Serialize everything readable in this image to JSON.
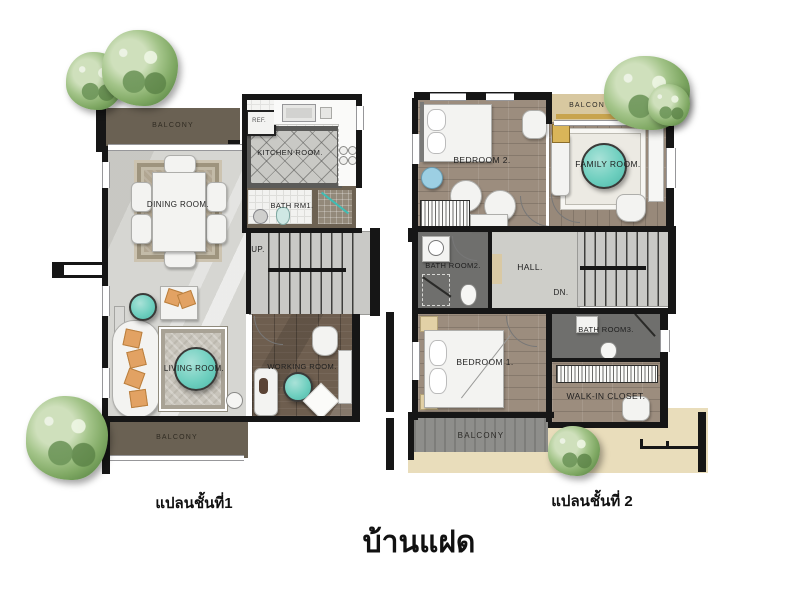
{
  "title": "บ้านแฝด",
  "floor1": {
    "caption": "แปลนชั้นที่1",
    "rooms": {
      "balcony_top": "BALCONY",
      "ref": "REF.",
      "kitchen": "KITCHEN ROOM.",
      "dining": "DINING ROOM.",
      "bath1": "BATH RM1.",
      "up": "UP.",
      "living": "LIVING ROOM.",
      "working": "WORKING ROOM.",
      "balcony_bottom": "BALCONY"
    }
  },
  "floor2": {
    "caption": "แปลนชั้นที่ 2",
    "rooms": {
      "bedroom2": "BEDROOM 2.",
      "balcony_top": "BALCONY",
      "family": "FAMILY ROOM.",
      "bath2": "BATH ROOM2.",
      "hall": "HALL.",
      "down": "DN.",
      "bedroom1": "BEDROOM 1.",
      "bath3": "BATH ROOM3.",
      "closet": "WALK-IN CLOSET.",
      "balcony_bottom": "BALCONY"
    }
  },
  "palette": {
    "wall": "#161616",
    "floor_gray": "#d6d6d2",
    "wood_dark": "#6e5e4f",
    "wood_mid": "#9c8d7e",
    "balcony_dark": "#6a6153",
    "balcony_gray": "#8e8e8b",
    "balcony_tan": "#d8c8a0",
    "terrace_tan": "#e9ddbb",
    "bath_gray": "#6f6f6d",
    "accent_teal": "#6fcfbf",
    "accent_orange": "#e2a263",
    "accent_blue": "#9ccfe3",
    "tree_green": "#7fa863"
  }
}
